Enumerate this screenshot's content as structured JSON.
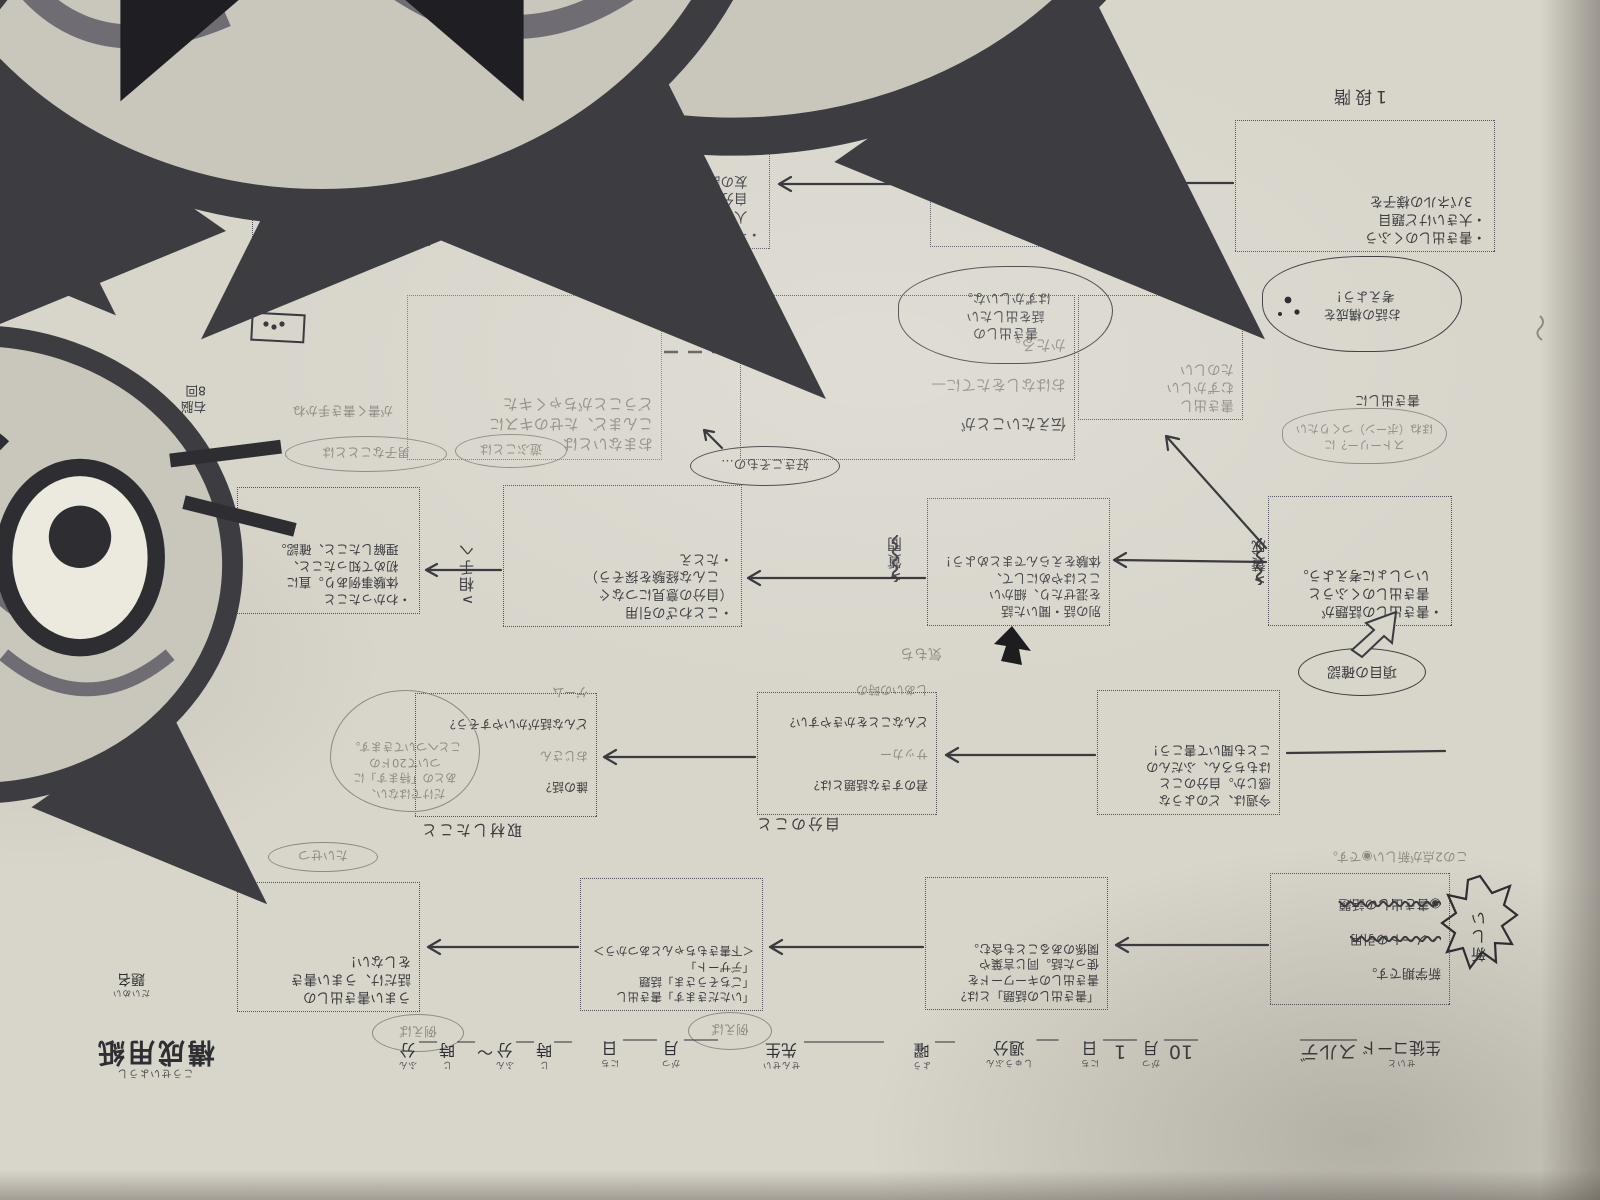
{
  "palette": {
    "paper": "#d8d5cb",
    "ink": "#3b3a3f",
    "pencil": "#8d8a83",
    "border": "#54525a"
  },
  "title_block": {
    "title": "構成用紙",
    "title_kana": "こうせいようし",
    "daimei": "題名",
    "daimei_kana": "だいめい"
  },
  "form": {
    "seito_kana": "せいと",
    "seito_label": "生徒コード",
    "seito_value": "スルデ",
    "month_label": "月",
    "month_kana": "がつ",
    "month_value": "10",
    "day_label": "日",
    "day_kana": "にち",
    "day_value": "1",
    "week_label": "週分",
    "week_kana": "しゅうぶん",
    "yobi_label": "曜",
    "yobi_kana": "よう",
    "sensei_label": "先生",
    "sensei_kana": "せんせい",
    "ji_label": "時",
    "ji_kana": "じ",
    "fun_label": "分",
    "fun_kana": "ふん",
    "tilde": "〜",
    "rei_oval": "例えば",
    "rei_oval2": "例えば"
  },
  "stages": {
    "s1_label": "1段階",
    "s1_lines": [
      "・書き出しのくふう",
      "・大きいけど題目",
      "　3パネルの様子を"
    ],
    "s2_label": "2段階",
    "s2_lines": [
      "・イズト話①",
      "　自分の好きな遊び",
      "　についてくわしく",
      "　書こう。"
    ],
    "s3_label": "3段階",
    "s3_lines": [
      "・イズト話②",
      "　人から聞いた話や",
      "　自分の昔の話、親",
      "　友の話を入れよう。"
    ],
    "s4_label": "4段階",
    "s4_lines": [
      "・イズト話を通し",
      "　て「わかったこと」",
      "・書き出しの終え"
    ],
    "kousei_bubble": [
      "お話の構成を",
      "考えよう！"
    ]
  },
  "row2": {
    "pencil_box": [
      "おまないとは",
      "こんまど、たせのキスに",
      "どうことがちゃくキた"
    ],
    "tsutae_box": [
      "伝えたいことが",
      "おはなしをたてに—",
      "かたる。"
    ],
    "kakidashi_box": [
      "書き出し",
      "むずかしい",
      "たのしい"
    ],
    "cat_bubble": [
      "書き出しの",
      "話を出したい",
      "はずかしいな。"
    ],
    "story_label": "書き出しに",
    "story_bubble": [
      "ストーリー？に",
      "ほね（ボーン）つくりたい"
    ],
    "unou_note": [
      "右脳",
      "8回"
    ],
    "kakite_note": "が書く書き手かね",
    "oval_asobi": "遊ぶことは",
    "oval_danshi": "男子なこととは",
    "oval_suki": "好きこそもの…"
  },
  "middle": {
    "m1_lines": [
      "・書き出しの話題が",
      "　書き出しのくふうと",
      "　いっしょに考えよう。"
    ],
    "m2_lines": [
      "別の話・聞いた話",
      "を混ぜたり、細かい",
      "ことはやめにして、",
      "体験をえらんでまとめよう！"
    ],
    "m3_lines": [
      "・ことわざの引用",
      "（自分の意見につなぐ",
      "　こんな経験を探そう）",
      "・たとえ"
    ],
    "m4_lines": [
      "・わかったこと",
      "　体験事例あり。直に",
      "　初めて知ったこと、",
      "　理解したこと、確認。"
    ],
    "label_sansei": "∧賛成",
    "label_shitsumon": "∧質問",
    "label_aite": "∧相手へ",
    "koumoku_oval": "項目の確認",
    "kimochi_note": "気もち"
  },
  "row3": {
    "r1_lines": [
      "今週は、どのような",
      "感じか。自分のこと",
      "はもちろん、ふだんの",
      "ことも聞いて書こう！"
    ],
    "r2": {
      "l1": "君のすきな話題とは？",
      "l2": "サッカー",
      "l3": "どんなことをかきやすい？",
      "l4": "しあいの時の"
    },
    "r3": {
      "l1": "誰の話？",
      "l2": "おじさん",
      "l3": "どんな話がかいやすそう？",
      "l4": "ゲーム"
    },
    "header_shuzai": "取材したこと",
    "header_jibun": "自分のこと",
    "circled_note": [
      "だけではない、",
      "あとの「特ます」に",
      "ついて20ドの",
      "ことへついてきます。"
    ],
    "margin_vertical": "好きこそ物の上手なれ"
  },
  "toprow": {
    "b1": {
      "l1": "新学期です。",
      "l2": "・ノートの引用",
      "l3": "◉書き出しの話題"
    },
    "b1_note": "この2点が新しい◉です。",
    "burst": "新しい",
    "b2_lines": [
      "「書き出しの話題」とは？",
      "書き出しのキーワードを",
      "使った話。同じ言葉や",
      "関係のあることも含む。"
    ],
    "b3_lines": [
      "「いただきます」書き出し",
      "「ごちそうさま」話題",
      "「デザート」",
      "＜下書きもちゃんとあつかう＞"
    ],
    "b4_lines": [
      "うまい書き出しの",
      "話だけ、うまい書き",
      "をしない！"
    ],
    "taisetsu_note": "たいせつ"
  }
}
